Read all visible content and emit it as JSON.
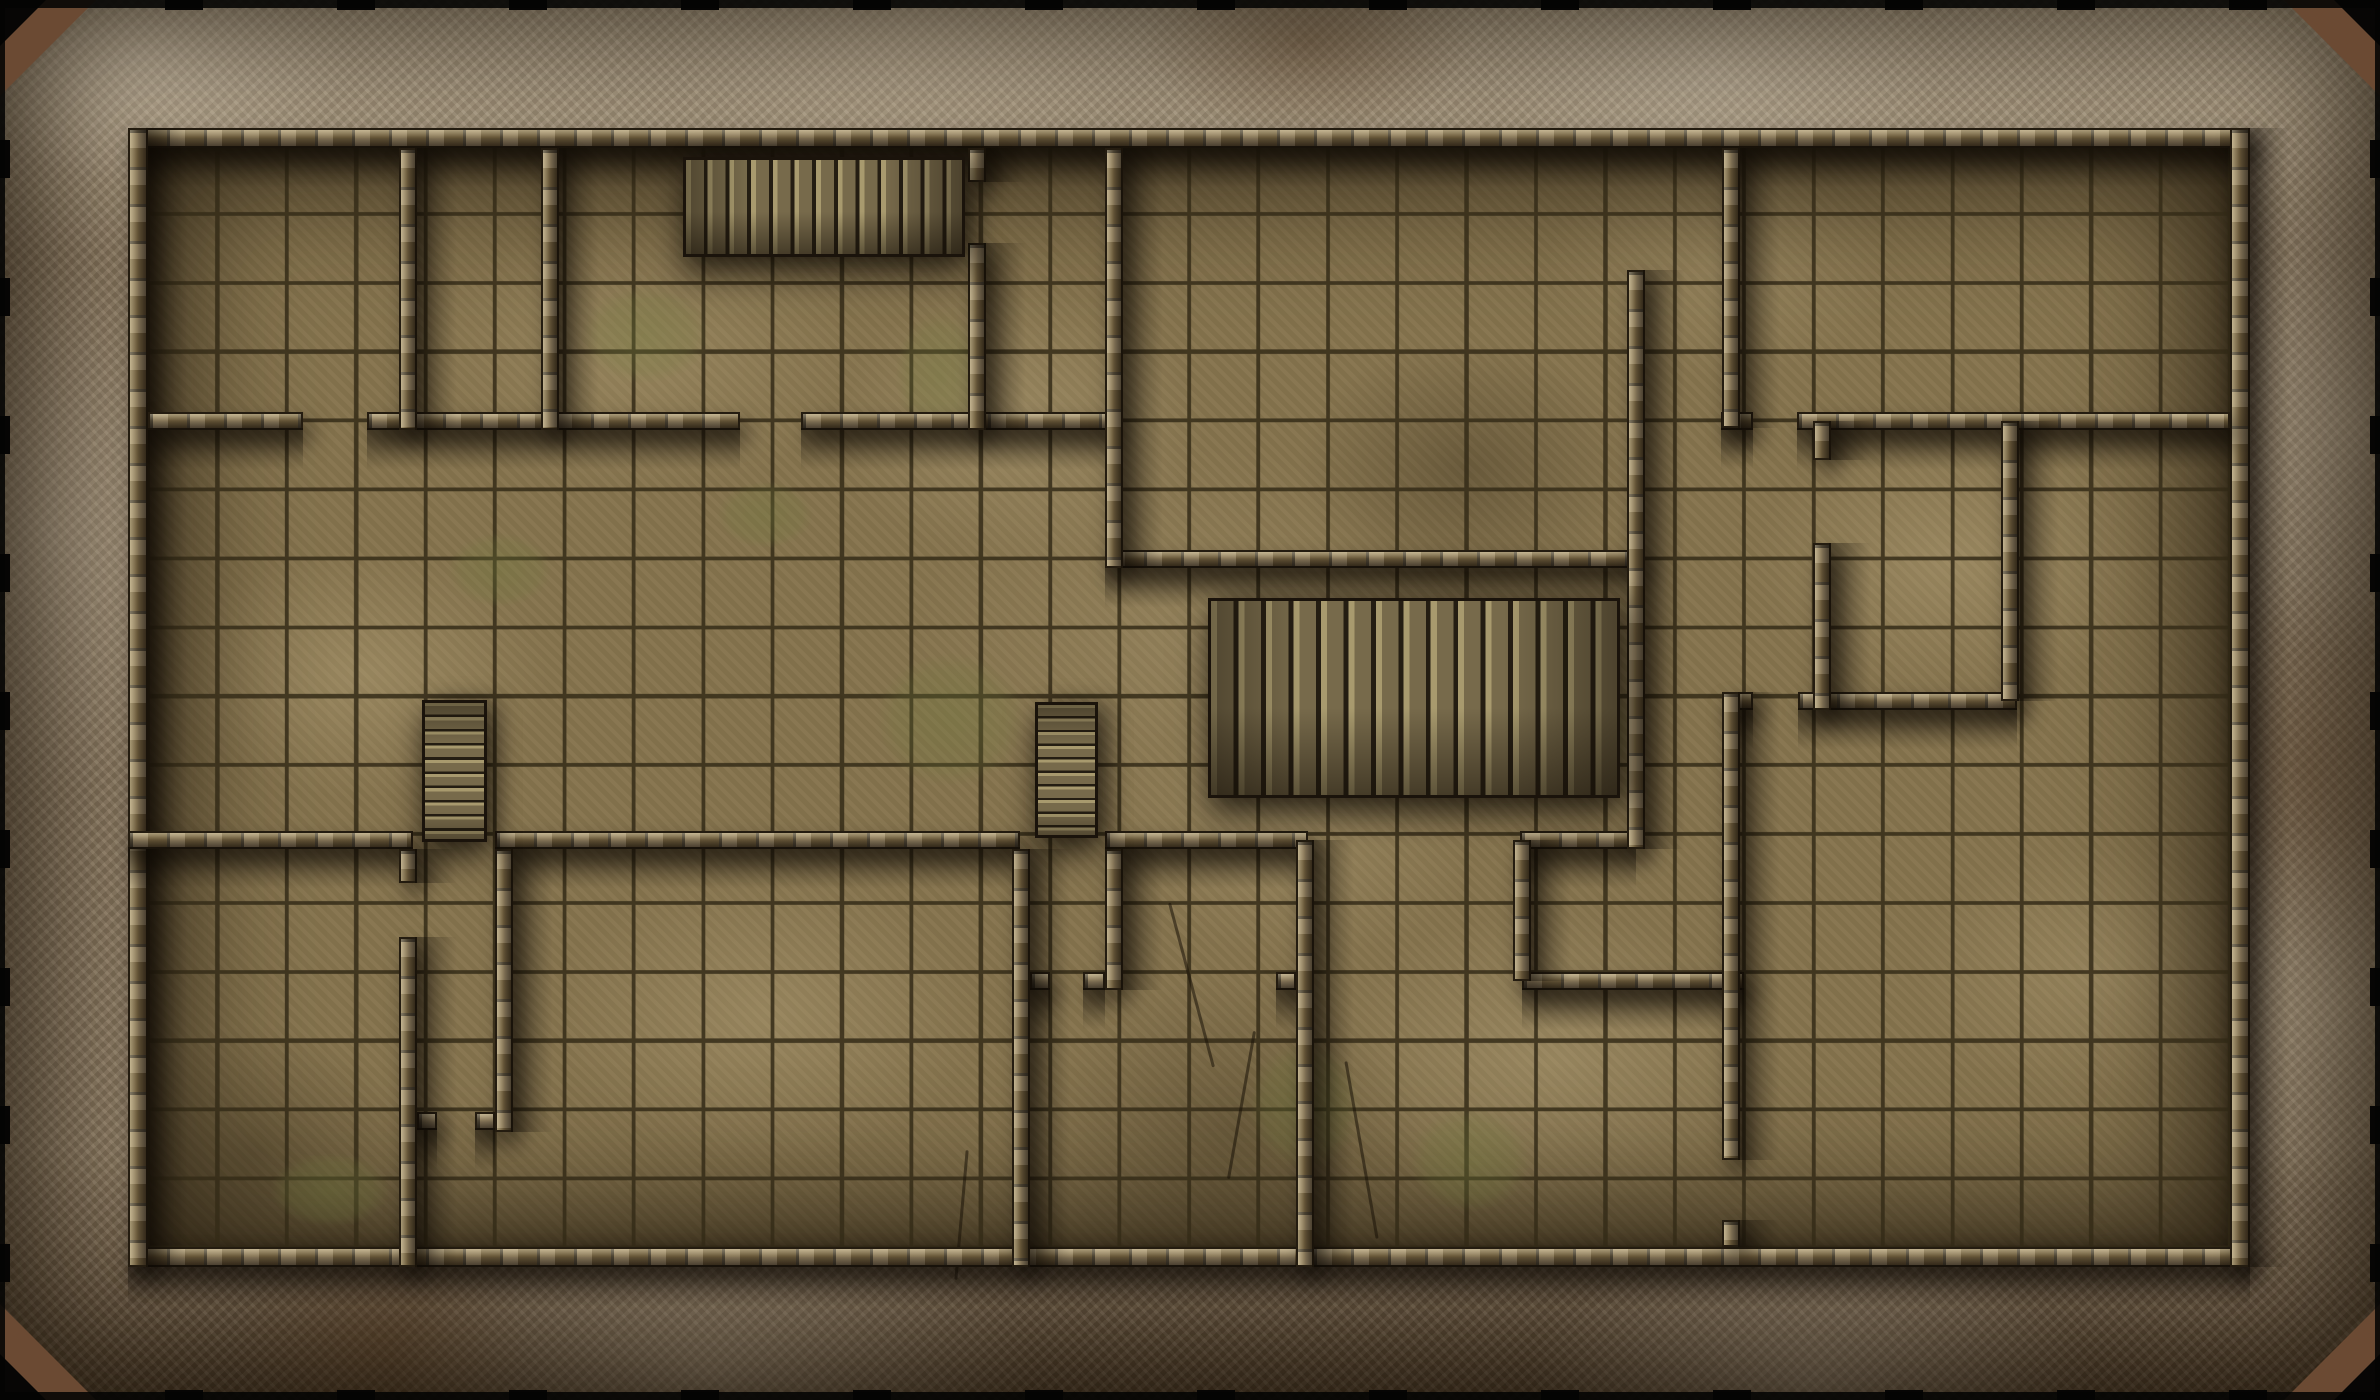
{
  "map": {
    "kind": "dungeon-battle-map",
    "canvas": {
      "width": 2380,
      "height": 1400
    },
    "grid": {
      "cols": 30,
      "rows": 16,
      "origin_x": 148,
      "origin_y": 145,
      "cell_w": 69.4,
      "cell_h": 68.9
    },
    "border": {
      "thickness": 128,
      "corner_chamfer": 96
    },
    "colors": {
      "rock-base": "#8d7b62",
      "rock-light": "#c3b49a",
      "rock-dark": "#4e3d2a",
      "corner-brown": "#6b4a33",
      "edge-black": "#0d0b08",
      "floor-base": "#86744e",
      "floor-light": "#c4b186",
      "floor-dark": "#3f3420",
      "grid-line": "#352c18",
      "wall-base": "#6f5d3d",
      "wall-light": "#a8925f",
      "wall-dark": "#241c10",
      "plank-light": "#a89a6e",
      "plank-mid": "#776a4b",
      "plank-dark": "#241d12",
      "moss": "#6f7a3c"
    },
    "outer_walls": [
      {
        "name": "outer-wall-top",
        "x": 128,
        "y": 128,
        "w": 2122,
        "h": 20,
        "o": "h"
      },
      {
        "name": "outer-wall-bottom",
        "x": 128,
        "y": 1247,
        "w": 2122,
        "h": 20,
        "o": "h"
      },
      {
        "name": "outer-wall-left",
        "x": 128,
        "y": 128,
        "w": 20,
        "h": 1139,
        "o": "v"
      },
      {
        "name": "outer-wall-right",
        "x": 2230,
        "y": 128,
        "w": 20,
        "h": 1139,
        "o": "v"
      }
    ],
    "walls": [
      {
        "x": 148,
        "y": 412,
        "w": 155,
        "h": 18,
        "o": "h"
      },
      {
        "x": 367,
        "y": 412,
        "w": 373,
        "h": 18,
        "o": "h"
      },
      {
        "x": 801,
        "y": 412,
        "w": 313,
        "h": 18,
        "o": "h"
      },
      {
        "x": 1721,
        "y": 412,
        "w": 32,
        "h": 18,
        "o": "h"
      },
      {
        "x": 1797,
        "y": 412,
        "w": 433,
        "h": 18,
        "o": "h"
      },
      {
        "x": 1105,
        "y": 550,
        "w": 538,
        "h": 18,
        "o": "h"
      },
      {
        "x": 1798,
        "y": 692,
        "w": 219,
        "h": 18,
        "o": "h"
      },
      {
        "x": 1722,
        "y": 692,
        "w": 31,
        "h": 18,
        "o": "h"
      },
      {
        "x": 128,
        "y": 831,
        "w": 285,
        "h": 18,
        "o": "h"
      },
      {
        "x": 495,
        "y": 831,
        "w": 525,
        "h": 18,
        "o": "h"
      },
      {
        "x": 1105,
        "y": 831,
        "w": 203,
        "h": 18,
        "o": "h"
      },
      {
        "x": 1520,
        "y": 831,
        "w": 116,
        "h": 18,
        "o": "h"
      },
      {
        "x": 1522,
        "y": 972,
        "w": 222,
        "h": 18,
        "o": "h"
      },
      {
        "x": 1030,
        "y": 972,
        "w": 20,
        "h": 18,
        "o": "h"
      },
      {
        "x": 1276,
        "y": 972,
        "w": 20,
        "h": 18,
        "o": "h"
      },
      {
        "x": 1083,
        "y": 972,
        "w": 22,
        "h": 18,
        "o": "h"
      },
      {
        "x": 417,
        "y": 1112,
        "w": 20,
        "h": 18,
        "o": "h"
      },
      {
        "x": 475,
        "y": 1112,
        "w": 20,
        "h": 18,
        "o": "h"
      },
      {
        "x": 399,
        "y": 148,
        "w": 18,
        "h": 282,
        "o": "v"
      },
      {
        "x": 541,
        "y": 148,
        "w": 18,
        "h": 282,
        "o": "v"
      },
      {
        "x": 968,
        "y": 148,
        "w": 18,
        "h": 34,
        "o": "v"
      },
      {
        "x": 968,
        "y": 243,
        "w": 18,
        "h": 187,
        "o": "v"
      },
      {
        "x": 1105,
        "y": 148,
        "w": 18,
        "h": 420,
        "o": "v"
      },
      {
        "x": 1627,
        "y": 270,
        "w": 18,
        "h": 579,
        "o": "v"
      },
      {
        "x": 1722,
        "y": 148,
        "w": 18,
        "h": 280,
        "o": "v"
      },
      {
        "x": 1813,
        "y": 421,
        "w": 18,
        "h": 39,
        "o": "v"
      },
      {
        "x": 1813,
        "y": 543,
        "w": 18,
        "h": 167,
        "o": "v"
      },
      {
        "x": 2001,
        "y": 421,
        "w": 18,
        "h": 280,
        "o": "v"
      },
      {
        "x": 1722,
        "y": 692,
        "w": 18,
        "h": 468,
        "o": "v"
      },
      {
        "x": 1722,
        "y": 1220,
        "w": 18,
        "h": 27,
        "o": "v"
      },
      {
        "x": 1513,
        "y": 840,
        "w": 18,
        "h": 141,
        "o": "v"
      },
      {
        "x": 1296,
        "y": 840,
        "w": 18,
        "h": 427,
        "o": "v"
      },
      {
        "x": 1105,
        "y": 849,
        "w": 18,
        "h": 141,
        "o": "v"
      },
      {
        "x": 1012,
        "y": 849,
        "w": 18,
        "h": 418,
        "o": "v"
      },
      {
        "x": 495,
        "y": 849,
        "w": 18,
        "h": 283,
        "o": "v"
      },
      {
        "x": 399,
        "y": 849,
        "w": 18,
        "h": 34,
        "o": "v"
      },
      {
        "x": 399,
        "y": 937,
        "w": 18,
        "h": 330,
        "o": "v"
      }
    ],
    "stairs": [
      {
        "x": 683,
        "y": 157,
        "w": 282,
        "h": 100,
        "dir": "ew",
        "planks": 13
      },
      {
        "x": 1208,
        "y": 598,
        "w": 412,
        "h": 200,
        "dir": "ew",
        "planks": 15
      },
      {
        "x": 422,
        "y": 700,
        "w": 65,
        "h": 142,
        "dir": "ns",
        "planks": 10
      },
      {
        "x": 1035,
        "y": 702,
        "w": 63,
        "h": 136,
        "dir": "ns",
        "planks": 10
      }
    ],
    "moss_patches": [
      {
        "x": 560,
        "y": 270,
        "w": 170,
        "h": 130
      },
      {
        "x": 880,
        "y": 290,
        "w": 120,
        "h": 170
      },
      {
        "x": 430,
        "y": 520,
        "w": 140,
        "h": 100
      },
      {
        "x": 850,
        "y": 630,
        "w": 200,
        "h": 180
      },
      {
        "x": 1330,
        "y": 690,
        "w": 170,
        "h": 120
      },
      {
        "x": 1550,
        "y": 650,
        "w": 90,
        "h": 160
      },
      {
        "x": 1230,
        "y": 1020,
        "w": 150,
        "h": 170
      },
      {
        "x": 1390,
        "y": 1090,
        "w": 160,
        "h": 140
      },
      {
        "x": 250,
        "y": 1140,
        "w": 160,
        "h": 100
      },
      {
        "x": 700,
        "y": 470,
        "w": 130,
        "h": 90
      }
    ],
    "cracks": [
      {
        "x": 1190,
        "y": 900,
        "len": 170,
        "angle": 75
      },
      {
        "x": 1240,
        "y": 1030,
        "len": 150,
        "angle": 100
      },
      {
        "x": 1360,
        "y": 1060,
        "len": 180,
        "angle": 80
      },
      {
        "x": 960,
        "y": 1150,
        "len": 130,
        "angle": 95
      }
    ],
    "edge_ticks": {
      "spacing_x": 172,
      "phase_x": 165,
      "spacing_y": 138,
      "phase_y": 140,
      "length": 38,
      "depth": 10
    }
  }
}
